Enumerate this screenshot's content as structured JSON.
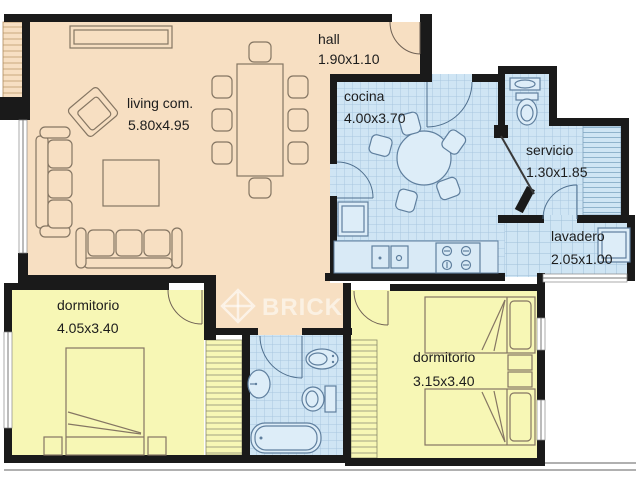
{
  "watermark": {
    "brand": "BRICK"
  },
  "palette": {
    "wall": "#1a1a1a",
    "floor_social": "#f7dfc2",
    "floor_wet": "#cfe5f4",
    "floor_bedroom": "#f7f7b5",
    "tile_line": "#a9c7df",
    "furniture_outline": "#857663",
    "fixture_outline": "#5f7f9e",
    "text": "#1c1c1c",
    "watermark_color": "rgba(255,255,255,0.55)"
  },
  "rooms": {
    "living": {
      "label": "living com.",
      "dims": "5.80x4.95"
    },
    "hall": {
      "label": "hall",
      "dims": "1.90x1.10"
    },
    "cocina": {
      "label": "cocina",
      "dims": "4.00x3.70"
    },
    "servicio": {
      "label": "servicio",
      "dims": "1.30x1.85"
    },
    "lavadero": {
      "label": "lavadero",
      "dims": "2.05x1.00"
    },
    "dormitorio_left": {
      "label": "dormitorio",
      "dims": "4.05x3.40"
    },
    "dormitorio_right": {
      "label": "dormitorio",
      "dims": "3.15x3.40"
    }
  },
  "icons": [
    "sofa",
    "armchair",
    "rug",
    "sideboard",
    "dining-table",
    "dining-chair",
    "round-table",
    "kitchen-chair",
    "fridge",
    "kitchen-counter",
    "double-sink",
    "stove",
    "toilet",
    "hand-basin",
    "stairs",
    "washing-machine",
    "bathtub",
    "washbasin",
    "bidet",
    "double-bed",
    "single-bed",
    "nightstand",
    "wardrobe",
    "door-swing",
    "window",
    "louver",
    "brand-logo"
  ]
}
